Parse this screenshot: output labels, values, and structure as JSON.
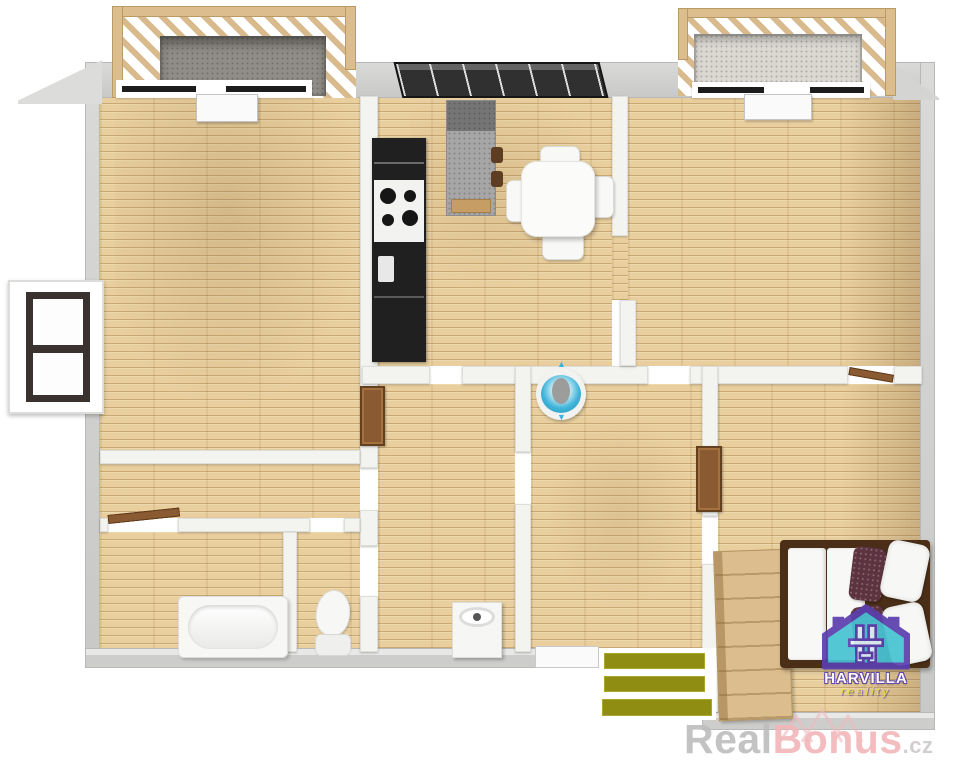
{
  "scene": {
    "description": "3D bird's-eye floor plan rendering of an apartment",
    "areas": [
      "balcony-left",
      "balcony-right",
      "living-room",
      "kitchen-dining",
      "room-top-right",
      "hallway",
      "bathroom",
      "wc",
      "room-bottom-left",
      "room-bottom-center",
      "bedroom",
      "entrance-mat"
    ],
    "furniture": [
      "kitchen-counter-with-stove",
      "refrigerator-column",
      "kitchen-island",
      "bar-stools",
      "dining-table",
      "dining-chairs",
      "blue-washbasin",
      "bathtub",
      "toilet",
      "washing-machine",
      "small-cabinet",
      "tall-cabinet",
      "wardrobe",
      "double-bed",
      "duvet",
      "pillows",
      "striped-mat",
      "open-doors"
    ]
  },
  "icons": {
    "arrow_up": "▲",
    "arrow_down": "▼"
  },
  "branding": {
    "agency": {
      "name": "HARVILLA",
      "tagline": "reality"
    },
    "watermark": {
      "real": "Real",
      "bonus": "Bonus",
      "cz": ".cz"
    }
  },
  "palette": {
    "wood": "#e9cf9e",
    "wood_line": "#d9b781",
    "outer_wall": "#d0d0ce",
    "inner_wall": "#f3f3f0",
    "kitchen_counter": "#202020",
    "island_granite": "#a6a6a6",
    "basin_blue": "#3fb3d9",
    "door_wood": "#8a5a32",
    "bed_frame": "#4a2e17",
    "pillow_accent": "#5c3340",
    "wardrobe_wood": "#dcbd8e",
    "railing_wood": "#d9ba8c",
    "balcony_floor_left": "#908d87",
    "balcony_floor_right": "#dbd8d1",
    "rug_olive": "#8f8d12",
    "window_frame": "#39322e",
    "logo_purple": "#5b3fae",
    "logo_teal": "#47c3d3",
    "logo_yellow": "#e9e24a",
    "watermark_gray": "#bdbdbd",
    "watermark_pink": "#f2b6ba"
  }
}
